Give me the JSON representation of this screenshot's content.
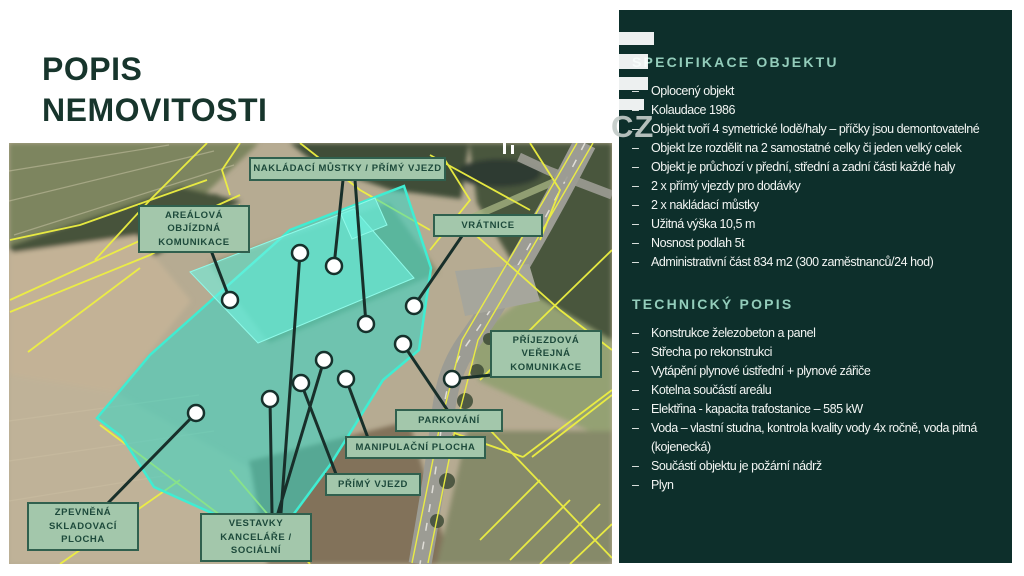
{
  "title": {
    "line1": "POPIS",
    "line2": "NEMOVITOSTI"
  },
  "watermark": {
    "text": "CZ"
  },
  "map": {
    "callouts": [
      {
        "id": "nakladaci",
        "label": "NAKLÁDACÍ MŮSTKY / PŘÍMÝ VJEZD"
      },
      {
        "id": "vratnice",
        "label": "VRÁTNICE"
      },
      {
        "id": "arealova",
        "label": "AREÁLOVÁ OBJÍZDNÁ KOMUNIKACE"
      },
      {
        "id": "prijezdova",
        "label": "PŘÍJEZDOVÁ VEŘEJNÁ KOMUNIKACE"
      },
      {
        "id": "parkovani",
        "label": "PARKOVÁNÍ"
      },
      {
        "id": "manipulacni",
        "label": "MANIPULAČNÍ PLOCHA"
      },
      {
        "id": "primy",
        "label": "PŘÍMÝ VJEZD"
      },
      {
        "id": "zpevnena",
        "label": "ZPEVNĚNÁ SKLADOVACÍ PLOCHA"
      },
      {
        "id": "vestavky",
        "label": "VESTAVKY KANCELÁŘE / SOCIÁLNÍ"
      }
    ]
  },
  "panel": {
    "bullet": "–",
    "sections": [
      {
        "title": "SPECIFIKACE OBJEKTU",
        "items": [
          "Oplocený objekt",
          "Kolaudace 1986",
          "Objekt tvoří 4 symetrické lodě/haly – příčky jsou demontovatelné",
          "Objekt lze rozdělit na 2 samostatné celky či jeden velký celek",
          "Objekt je průchozí v přední, střední a zadní části každé haly",
          "2 x přímý vjezdy pro dodávky",
          "2 x nakládací můstky",
          "Užitná výška 10,5 m",
          "Nosnost podlah 5t",
          "Administrativní část 834 m2 (300 zaměstnanců/24 hod)"
        ]
      },
      {
        "title": "TECHNICKÝ POPIS",
        "items": [
          "Konstrukce železobeton a panel",
          "Střecha po rekonstrukci",
          "Vytápění plynové ústřední + plynové zářiče",
          "Kotelna součástí areálu",
          "Elektřina - kapacita trafostanice – 585 kW",
          "Voda – vlastní studna, kontrola kvality vody 4x ročně, voda pitná (kojenecká)",
          "Součástí objektu je požární nádrž",
          "Plyn"
        ]
      }
    ]
  },
  "colors": {
    "panel_bg": "#0d2f2b",
    "section_title": "#93cdbb",
    "title_text": "#17352c",
    "label_bg": "#a3c7ab",
    "label_border": "#30604e",
    "highlight_teal": "#2fd9c8",
    "cadastral_yellow": "#eef041"
  }
}
